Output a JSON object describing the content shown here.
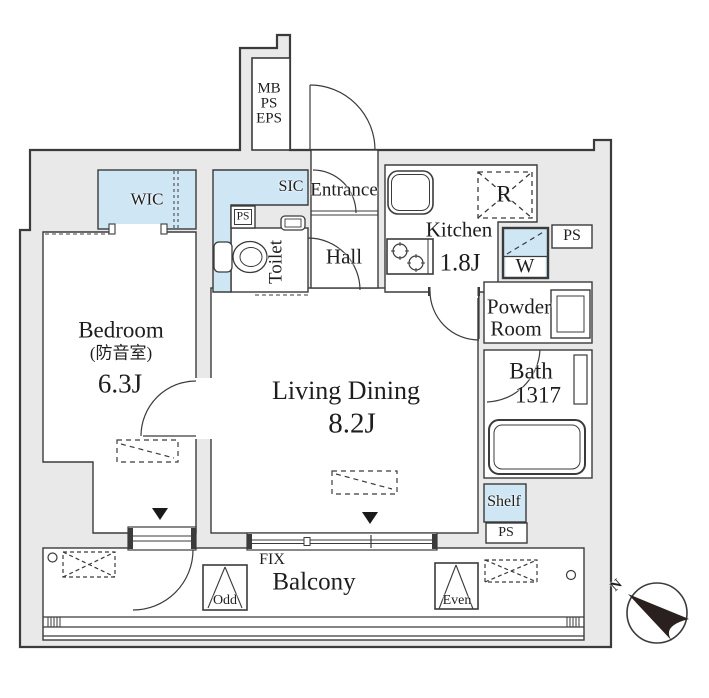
{
  "colors": {
    "wall_fill": "#e9e9e9",
    "accent_blue": "#cfe6f5",
    "line": "#3b3b3b"
  },
  "shaft": {
    "mb": "MB",
    "ps": "PS",
    "eps": "EPS"
  },
  "rooms": {
    "wic": {
      "label": "WIC"
    },
    "sic": {
      "label": "SIC"
    },
    "entrance": {
      "label": "Entrance"
    },
    "toilet": {
      "label": "Toilet"
    },
    "hall": {
      "label": "Hall"
    },
    "kitchen": {
      "name": "Kitchen",
      "size": "1.8J"
    },
    "bedroom": {
      "name": "Bedroom",
      "name_ja": "(防音室)",
      "size": "6.3J"
    },
    "living_dining": {
      "name": "Living Dining",
      "size": "8.2J"
    },
    "powder_room": {
      "line1": "Powder",
      "line2": "Room"
    },
    "bath": {
      "name": "Bath",
      "size": "1317"
    },
    "balcony": {
      "label": "Balcony"
    }
  },
  "features": {
    "refrigerator": "R",
    "washer": "W",
    "shelf": "Shelf",
    "ps_entry": "PS",
    "ps_kitchen": "PS",
    "ps_balcony": "PS",
    "fix_window": "FIX",
    "ac_odd": "Odd",
    "ac_even": "Even",
    "compass_north": "N"
  }
}
